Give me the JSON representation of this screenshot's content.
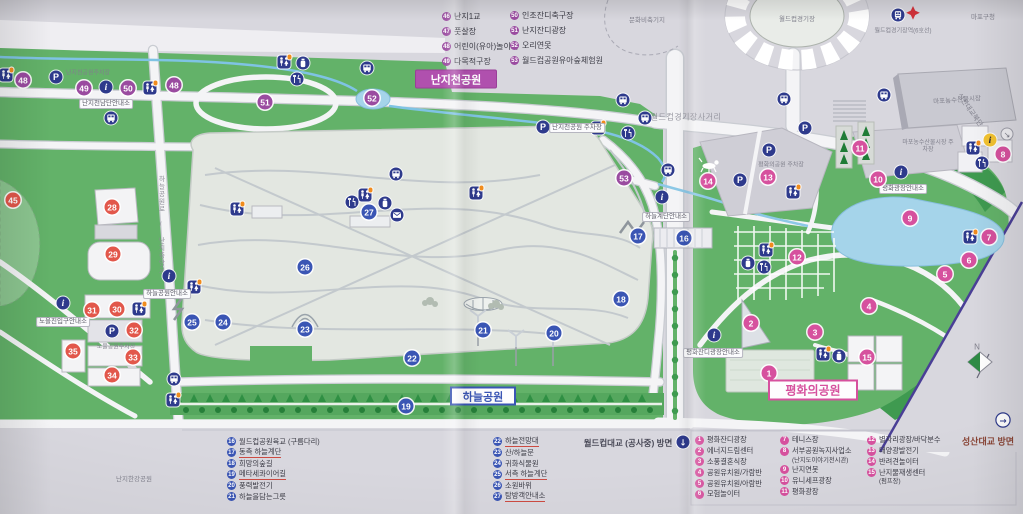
{
  "colors": {
    "paper": "#d8d7de",
    "green": "#63b269",
    "water": "#a5d4ea",
    "navy": "#2e3a8c",
    "sky_series": "#3a55b4",
    "peace_series": "#d6519e",
    "nanji_series": "#9a4ba0",
    "noeul_series": "#e2574b",
    "badge_nanji": "#b050ae",
    "maroon": "#8a4536"
  },
  "parks": {
    "nanjicheon": "난지천공원",
    "haneul": "하늘공원",
    "pyeonghwa": "평화의공원"
  },
  "directions": {
    "worldcup_bridge": "월드컵대교 (공사중) 방면",
    "seongsan_bridge": "성산대교 방면"
  },
  "legend_top": [
    {
      "num": 46,
      "label": "난지1교"
    },
    {
      "num": 47,
      "label": "풋살장"
    },
    {
      "num": 48,
      "label": "어린이(유아)놀이터"
    },
    {
      "num": 49,
      "label": "다목적구장"
    },
    {
      "num": 50,
      "label": "인조잔디축구장"
    },
    {
      "num": 51,
      "label": "난지잔디광장"
    },
    {
      "num": 52,
      "label": "오리연못"
    },
    {
      "num": 53,
      "label": "월드컵공원유아숲체험원"
    }
  ],
  "legend_sky": [
    {
      "num": 16,
      "label": "월드컵공원육교 (구름다리)",
      "underline": false
    },
    {
      "num": 17,
      "label": "동측 하늘계단",
      "underline": true
    },
    {
      "num": 18,
      "label": "희망의숲길",
      "underline": false
    },
    {
      "num": 19,
      "label": "메타세콰이어길",
      "underline": true
    },
    {
      "num": 20,
      "label": "풍력발전기",
      "underline": false
    },
    {
      "num": 21,
      "label": "하늘을담는그릇",
      "underline": false
    },
    {
      "num": 22,
      "label": "하늘전망대",
      "underline": true
    },
    {
      "num": 23,
      "label": "산/하늘문",
      "underline": false
    },
    {
      "num": 24,
      "label": "귀화식물원",
      "underline": false
    },
    {
      "num": 25,
      "label": "서측 하늘계단",
      "underline": true
    },
    {
      "num": 26,
      "label": "소원바위",
      "underline": false
    },
    {
      "num": 27,
      "label": "탐방객안내소",
      "underline": true
    }
  ],
  "legend_peace": [
    {
      "num": 1,
      "label": "평화잔디광장"
    },
    {
      "num": 2,
      "label": "에너지드림센터"
    },
    {
      "num": 3,
      "label": "소풍결혼식장"
    },
    {
      "num": 4,
      "label": "공원유치원/가람반"
    },
    {
      "num": 5,
      "label": "공원유치원/아람반"
    },
    {
      "num": 6,
      "label": "모험놀이터"
    },
    {
      "num": 7,
      "label": "테니스장"
    },
    {
      "num": 8,
      "label": "서부공원녹지사업소",
      "sub": "(난지도이야기전시관)"
    },
    {
      "num": 9,
      "label": "난지연못"
    },
    {
      "num": 10,
      "label": "유니세프광장"
    },
    {
      "num": 11,
      "label": "평화광장"
    },
    {
      "num": 12,
      "label": "별자리광장/바닥분수"
    },
    {
      "num": 13,
      "label": "태양광발전기"
    },
    {
      "num": 14,
      "label": "반려견놀이터"
    },
    {
      "num": 15,
      "label": "난지물재생센터",
      "sub": "(펌프장)"
    }
  ],
  "markers": [
    {
      "num": 48,
      "x": 23,
      "y": 80,
      "series": "nanji"
    },
    {
      "num": 49,
      "x": 84,
      "y": 88,
      "series": "nanji"
    },
    {
      "num": 50,
      "x": 128,
      "y": 88,
      "series": "nanji"
    },
    {
      "num": 48,
      "x": 174,
      "y": 85,
      "series": "nanji"
    },
    {
      "num": 51,
      "x": 265,
      "y": 102,
      "series": "nanji"
    },
    {
      "num": 52,
      "x": 372,
      "y": 98,
      "series": "nanji"
    },
    {
      "num": 53,
      "x": 624,
      "y": 178,
      "series": "nanji"
    },
    {
      "num": 45,
      "x": 13,
      "y": 200,
      "series": "noeul"
    },
    {
      "num": 28,
      "x": 112,
      "y": 207,
      "series": "noeul"
    },
    {
      "num": 29,
      "x": 113,
      "y": 254,
      "series": "noeul"
    },
    {
      "num": 31,
      "x": 92,
      "y": 310,
      "series": "noeul"
    },
    {
      "num": 30,
      "x": 117,
      "y": 309,
      "series": "noeul"
    },
    {
      "num": 32,
      "x": 134,
      "y": 330,
      "series": "noeul"
    },
    {
      "num": 35,
      "x": 73,
      "y": 351,
      "series": "noeul"
    },
    {
      "num": 33,
      "x": 133,
      "y": 357,
      "series": "noeul"
    },
    {
      "num": 34,
      "x": 112,
      "y": 375,
      "series": "noeul"
    },
    {
      "num": 16,
      "x": 684,
      "y": 238,
      "series": "sky"
    },
    {
      "num": 17,
      "x": 638,
      "y": 236,
      "series": "sky"
    },
    {
      "num": 18,
      "x": 621,
      "y": 299,
      "series": "sky"
    },
    {
      "num": 19,
      "x": 406,
      "y": 406,
      "series": "sky"
    },
    {
      "num": 20,
      "x": 554,
      "y": 333,
      "series": "sky"
    },
    {
      "num": 21,
      "x": 483,
      "y": 330,
      "series": "sky"
    },
    {
      "num": 22,
      "x": 412,
      "y": 358,
      "series": "sky"
    },
    {
      "num": 23,
      "x": 305,
      "y": 329,
      "series": "sky"
    },
    {
      "num": 24,
      "x": 223,
      "y": 322,
      "series": "sky"
    },
    {
      "num": 25,
      "x": 192,
      "y": 322,
      "series": "sky"
    },
    {
      "num": 26,
      "x": 305,
      "y": 267,
      "series": "sky"
    },
    {
      "num": 27,
      "x": 369,
      "y": 212,
      "series": "sky"
    },
    {
      "num": 1,
      "x": 769,
      "y": 373,
      "series": "peace"
    },
    {
      "num": 2,
      "x": 751,
      "y": 323,
      "series": "peace"
    },
    {
      "num": 3,
      "x": 815,
      "y": 332,
      "series": "peace"
    },
    {
      "num": 4,
      "x": 869,
      "y": 306,
      "series": "peace"
    },
    {
      "num": 5,
      "x": 945,
      "y": 274,
      "series": "peace"
    },
    {
      "num": 6,
      "x": 969,
      "y": 260,
      "series": "peace"
    },
    {
      "num": 7,
      "x": 989,
      "y": 237,
      "series": "peace"
    },
    {
      "num": 8,
      "x": 1003,
      "y": 154,
      "series": "peace"
    },
    {
      "num": 9,
      "x": 910,
      "y": 218,
      "series": "peace"
    },
    {
      "num": 10,
      "x": 878,
      "y": 179,
      "series": "peace"
    },
    {
      "num": 11,
      "x": 860,
      "y": 148,
      "series": "peace"
    },
    {
      "num": 12,
      "x": 797,
      "y": 257,
      "series": "peace"
    },
    {
      "num": 13,
      "x": 768,
      "y": 177,
      "series": "peace"
    },
    {
      "num": 14,
      "x": 708,
      "y": 181,
      "series": "peace"
    },
    {
      "num": 15,
      "x": 867,
      "y": 357,
      "series": "peace"
    }
  ],
  "icons": [
    {
      "type": "restroom",
      "x": 6,
      "y": 75,
      "dot": true
    },
    {
      "type": "restroom",
      "x": 150,
      "y": 88,
      "dot": true
    },
    {
      "type": "restroom",
      "x": 284,
      "y": 62,
      "dot": true
    },
    {
      "type": "restroom",
      "x": 237,
      "y": 209,
      "dot": true
    },
    {
      "type": "restroom",
      "x": 365,
      "y": 195,
      "dot": true
    },
    {
      "type": "restroom",
      "x": 476,
      "y": 193,
      "dot": true
    },
    {
      "type": "restroom",
      "x": 194,
      "y": 287,
      "dot": true
    },
    {
      "type": "restroom",
      "x": 139,
      "y": 309,
      "dot": true
    },
    {
      "type": "restroom",
      "x": 173,
      "y": 400,
      "dot": true
    },
    {
      "type": "restroom",
      "x": 598,
      "y": 128,
      "dot": true
    },
    {
      "type": "restroom",
      "x": 793,
      "y": 192,
      "dot": true
    },
    {
      "type": "restroom",
      "x": 973,
      "y": 148,
      "dot": true
    },
    {
      "type": "restroom",
      "x": 970,
      "y": 237,
      "dot": true
    },
    {
      "type": "restroom",
      "x": 766,
      "y": 250,
      "dot": true
    },
    {
      "type": "restroom",
      "x": 823,
      "y": 354,
      "dot": true
    },
    {
      "type": "bus",
      "x": 111,
      "y": 118
    },
    {
      "type": "bus",
      "x": 367,
      "y": 68
    },
    {
      "type": "bus",
      "x": 623,
      "y": 100
    },
    {
      "type": "bus",
      "x": 645,
      "y": 118
    },
    {
      "type": "bus",
      "x": 668,
      "y": 170
    },
    {
      "type": "bus",
      "x": 396,
      "y": 174
    },
    {
      "type": "bus",
      "x": 174,
      "y": 379
    },
    {
      "type": "bus",
      "x": 784,
      "y": 99
    },
    {
      "type": "bus",
      "x": 884,
      "y": 95
    },
    {
      "type": "parking",
      "x": 56,
      "y": 77
    },
    {
      "type": "parking",
      "x": 543,
      "y": 127
    },
    {
      "type": "parking",
      "x": 112,
      "y": 331
    },
    {
      "type": "parking",
      "x": 805,
      "y": 128
    },
    {
      "type": "parking",
      "x": 769,
      "y": 150
    },
    {
      "type": "parking",
      "x": 740,
      "y": 180
    },
    {
      "type": "info",
      "x": 106,
      "y": 87
    },
    {
      "type": "info",
      "x": 169,
      "y": 276
    },
    {
      "type": "info",
      "x": 63,
      "y": 303
    },
    {
      "type": "info",
      "x": 662,
      "y": 197
    },
    {
      "type": "info",
      "x": 901,
      "y": 172
    },
    {
      "type": "info",
      "x": 714,
      "y": 335
    },
    {
      "type": "food",
      "x": 352,
      "y": 202
    },
    {
      "type": "food",
      "x": 628,
      "y": 133
    },
    {
      "type": "food",
      "x": 297,
      "y": 79
    },
    {
      "type": "food",
      "x": 982,
      "y": 163
    },
    {
      "type": "food",
      "x": 764,
      "y": 267
    },
    {
      "type": "cup",
      "x": 385,
      "y": 203
    },
    {
      "type": "cup",
      "x": 303,
      "y": 63
    },
    {
      "type": "cup",
      "x": 748,
      "y": 263
    },
    {
      "type": "cup",
      "x": 839,
      "y": 356
    },
    {
      "type": "mail",
      "x": 397,
      "y": 215
    },
    {
      "type": "train",
      "x": 898,
      "y": 15
    },
    {
      "type": "info-yellow",
      "x": 990,
      "y": 140
    },
    {
      "type": "arrow-down",
      "x": 683,
      "y": 442
    },
    {
      "type": "arrow-right",
      "x": 1003,
      "y": 420
    },
    {
      "type": "arrow-ne",
      "x": 1007,
      "y": 134
    }
  ],
  "map_labels": [
    {
      "text": "난지천공원주차장",
      "x": 88,
      "y": 72,
      "kind": "gray",
      "size": 6
    },
    {
      "text": "난지천남단안내소",
      "x": 106,
      "y": 104,
      "kind": "pill"
    },
    {
      "text": "난지천공원 주차장",
      "x": 577,
      "y": 128,
      "kind": "pill"
    },
    {
      "text": "하늘계단안내소",
      "x": 666,
      "y": 217,
      "kind": "pill"
    },
    {
      "text": "하늘공원안내소",
      "x": 167,
      "y": 294,
      "kind": "pill"
    },
    {
      "text": "노을진입구안내소",
      "x": 63,
      "y": 322,
      "kind": "pill"
    },
    {
      "text": "노을공원주차장",
      "x": 116,
      "y": 346,
      "kind": "gray",
      "size": 6
    },
    {
      "text": "평화의공원 주차장",
      "x": 781,
      "y": 164,
      "kind": "gray",
      "size": 6
    },
    {
      "text": "마포농수산물시장 주차장",
      "x": 928,
      "y": 147,
      "kind": "gray",
      "size": 6,
      "w": 52
    },
    {
      "text": "평화광장안내소",
      "x": 903,
      "y": 189,
      "kind": "pill"
    },
    {
      "text": "평화잔디광장안내소",
      "x": 713,
      "y": 353,
      "kind": "pill"
    },
    {
      "text": "마포농수산물시장",
      "x": 957,
      "y": 99,
      "kind": "gray",
      "size": 6.5,
      "rot": -4
    },
    {
      "text": "월드컵경기장",
      "x": 797,
      "y": 18,
      "kind": "gray",
      "size": 6.5
    },
    {
      "text": "월드컵경기장역(6호선)",
      "x": 903,
      "y": 30,
      "kind": "gray",
      "size": 6
    },
    {
      "text": "마포구청",
      "x": 983,
      "y": 16,
      "kind": "gray",
      "size": 6.5
    },
    {
      "text": "문화비축기지",
      "x": 647,
      "y": 19,
      "kind": "gray",
      "size": 6.5
    },
    {
      "text": "월드컵경기장사거리",
      "x": 686,
      "y": 117,
      "kind": "road"
    },
    {
      "text": "난지한강공원",
      "x": 134,
      "y": 478,
      "kind": "gray",
      "size": 6.5
    },
    {
      "text": "성산대교북단",
      "x": 970,
      "y": 110,
      "kind": "gray",
      "size": 7,
      "rot": 55
    },
    {
      "text": "하늘공원로 / 난지중앙로",
      "x": 160,
      "y": 225,
      "kind": "vroad"
    },
    {
      "text": "N",
      "x": 977,
      "y": 347,
      "kind": "gray",
      "size": 8
    }
  ]
}
